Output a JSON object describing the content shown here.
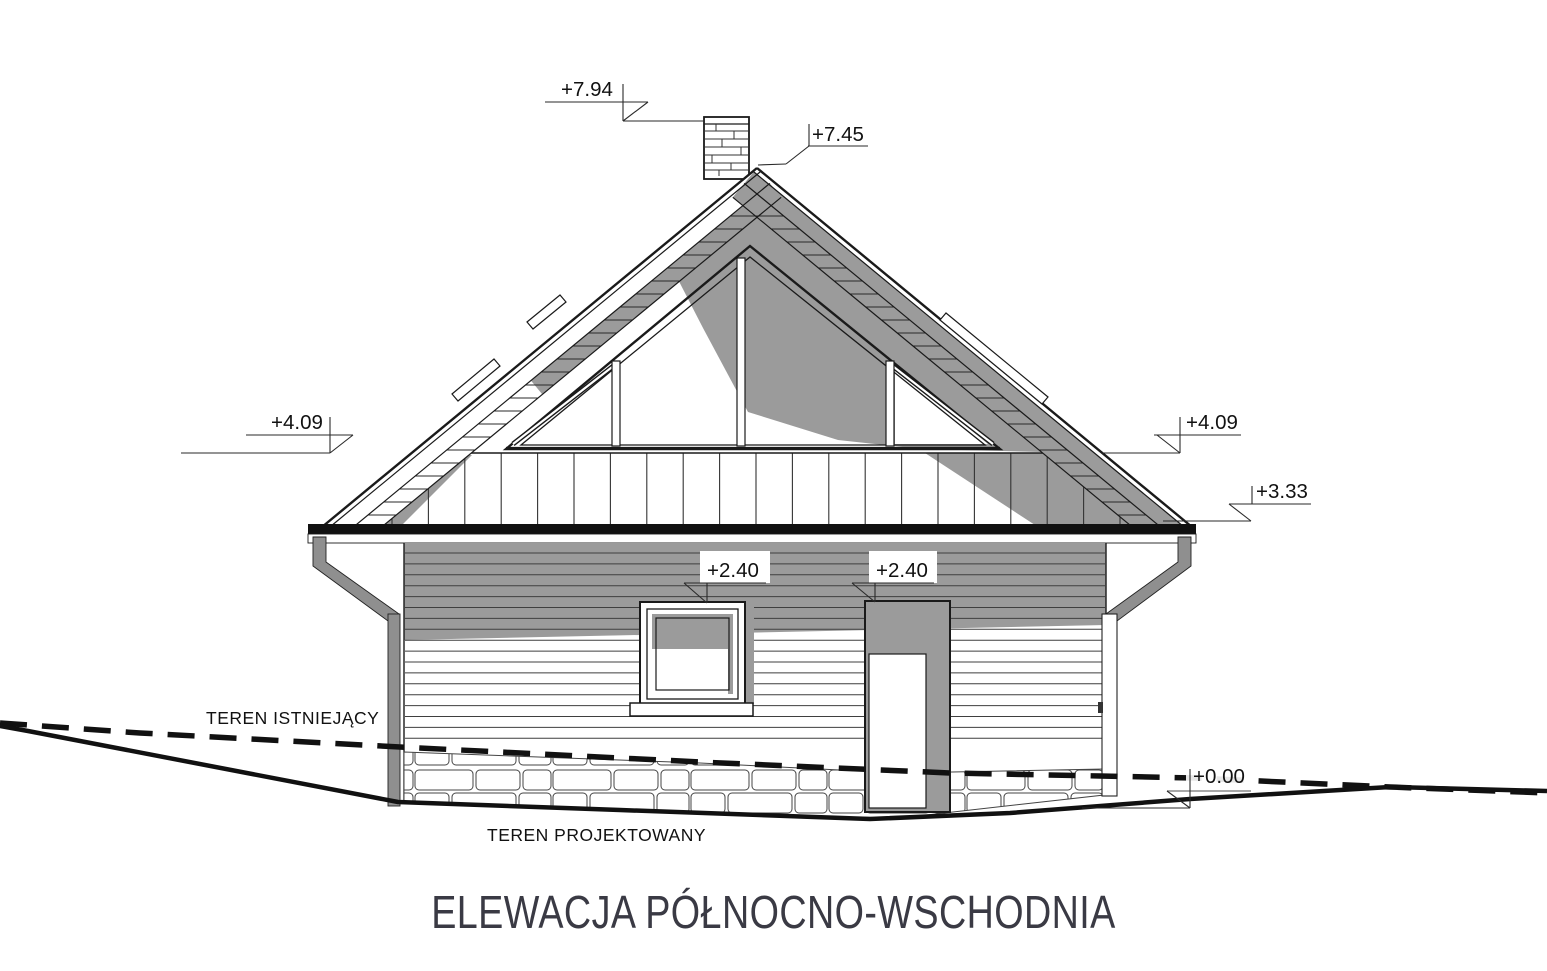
{
  "title": "ELEWACJA PÓŁNOCNO-WSCHODNIA",
  "terrain": {
    "existing_label": "TEREN ISTNIEJĄCY",
    "designed_label": "TEREN PROJEKTOWANY"
  },
  "elevation_markers": {
    "chimney_top": "+7.94",
    "ridge": "+7.45",
    "eaves_left": "+4.09",
    "eaves_right": "+4.09",
    "skirt_roof_right": "+3.33",
    "window_head": "+2.40",
    "door_head": "+2.40",
    "ground_level": "+0.00"
  },
  "colors": {
    "background": "#ffffff",
    "line": "#1a1a1a",
    "shadow": "#9b9b9b",
    "pipe_gray": "#8f8f8f",
    "title_text": "#3a3a44"
  }
}
